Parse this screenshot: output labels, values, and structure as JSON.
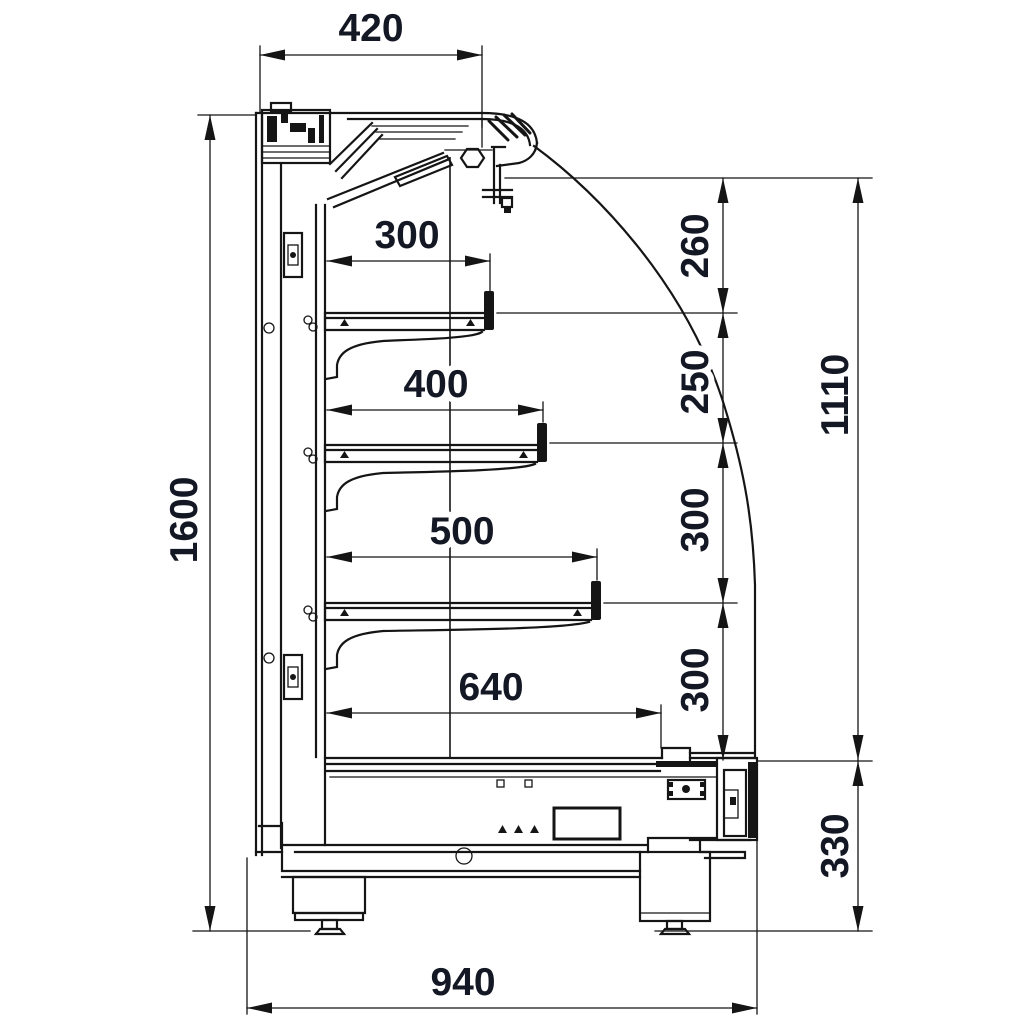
{
  "drawing": {
    "background_color": "#ffffff",
    "line_color": "#151515",
    "dimension_text_color": "#141824",
    "dimensions": {
      "top_depth": "420",
      "overall_height": "1600",
      "shelf1_depth": "300",
      "shelf2_depth": "400",
      "shelf3_depth": "500",
      "base_shelf_depth": "640",
      "gap_canopy_shelf1": "260",
      "gap_shelf1_shelf2": "250",
      "gap_shelf2_shelf3": "300",
      "gap_shelf3_base": "300",
      "opening_height": "1110",
      "base_height": "330",
      "overall_depth": "940"
    }
  }
}
